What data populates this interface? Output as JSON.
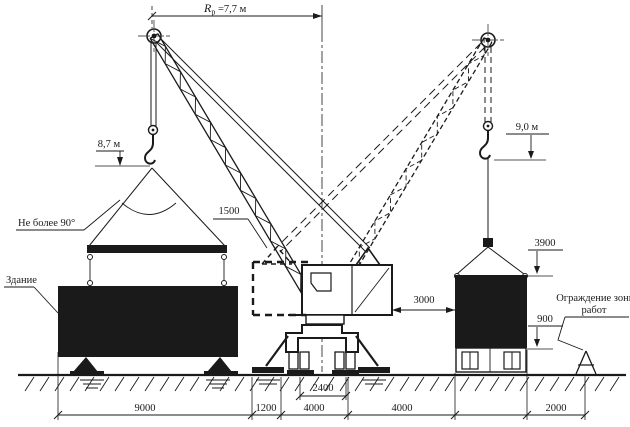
{
  "colors": {
    "ink": "#1a1a1a",
    "paper": "#ffffff"
  },
  "diagram": {
    "type": "crane-lifting-scheme",
    "labels": {
      "boom_radius": {
        "prefix": "R",
        "sub": "р",
        "rest": " =7,7 м"
      },
      "left_hook_height": "8,7 м",
      "right_hook_height": "9,0 м",
      "sling_angle": "Не более 90°",
      "building": "Здание",
      "tail_clearance": "1500",
      "crane_to_load_gap": "3000",
      "load_top_height": "3900",
      "platform_height": "900",
      "rail_gauge": "2400",
      "fence_line1": "Ограждение зоны",
      "fence_line2": "работ",
      "bottom_dims": [
        "9000",
        "1200",
        "4000",
        "4000",
        "2000"
      ]
    }
  }
}
